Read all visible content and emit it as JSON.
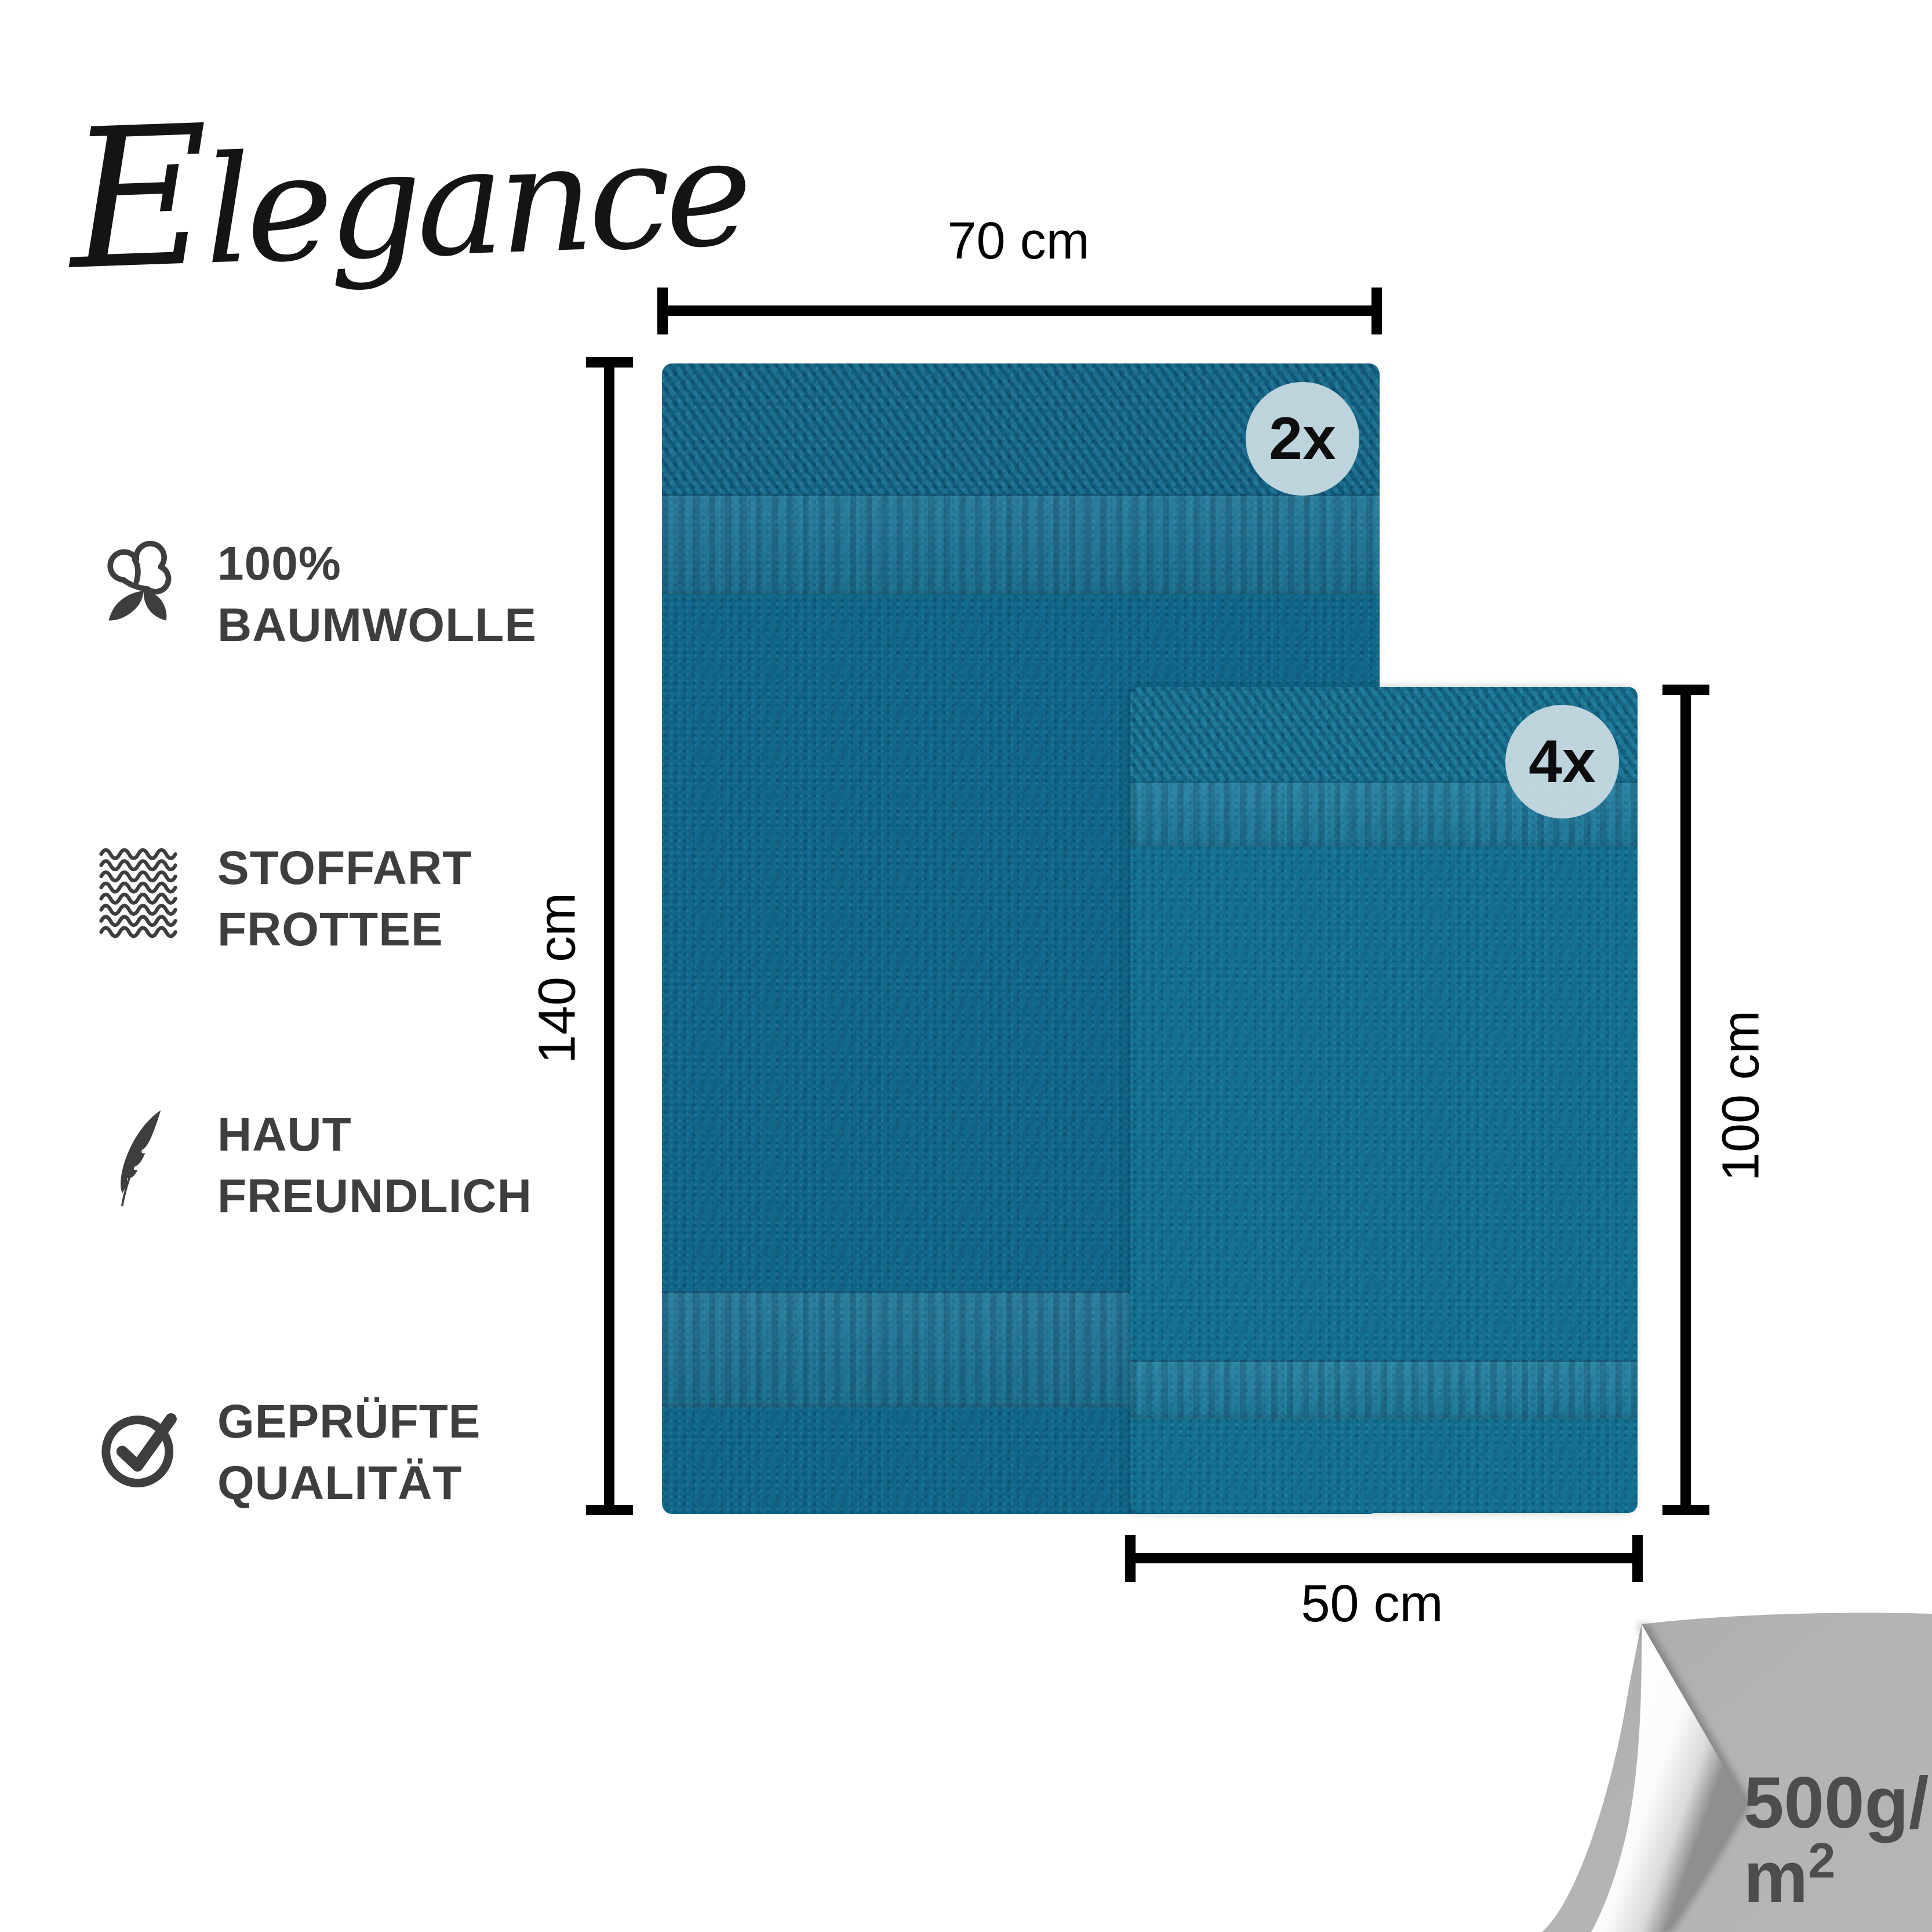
{
  "brand": {
    "logo": "Elegance"
  },
  "features": [
    {
      "icon": "cotton-icon",
      "lines": [
        "100%",
        "BAUMWOLLE"
      ]
    },
    {
      "icon": "fabric-knit-icon",
      "lines": [
        "STOFFART",
        "FROTTEE"
      ]
    },
    {
      "icon": "feather-icon",
      "lines": [
        "HAUT",
        "FREUNDLICH"
      ]
    },
    {
      "icon": "check-circle-icon",
      "lines": [
        "GEPRÜFTE",
        "QUALITÄT"
      ]
    }
  ],
  "towels": {
    "large": {
      "count_badge": "2x",
      "width_label": "70 cm",
      "height_label": "140 cm"
    },
    "small": {
      "count_badge": "4x",
      "width_label": "50 cm",
      "height_label": "100 cm"
    }
  },
  "weight": {
    "line1": "500g/",
    "line2_base": "m",
    "line2_sup": "2"
  },
  "colors": {
    "towel_large": "#12688a",
    "towel_small": "#147192",
    "badge_background": "#c7dae2",
    "feature_text": "#3e3e3e",
    "dimension_black": "#000000",
    "underside_gray": "#b3b3b3",
    "weight_text": "#4d4d4d"
  }
}
